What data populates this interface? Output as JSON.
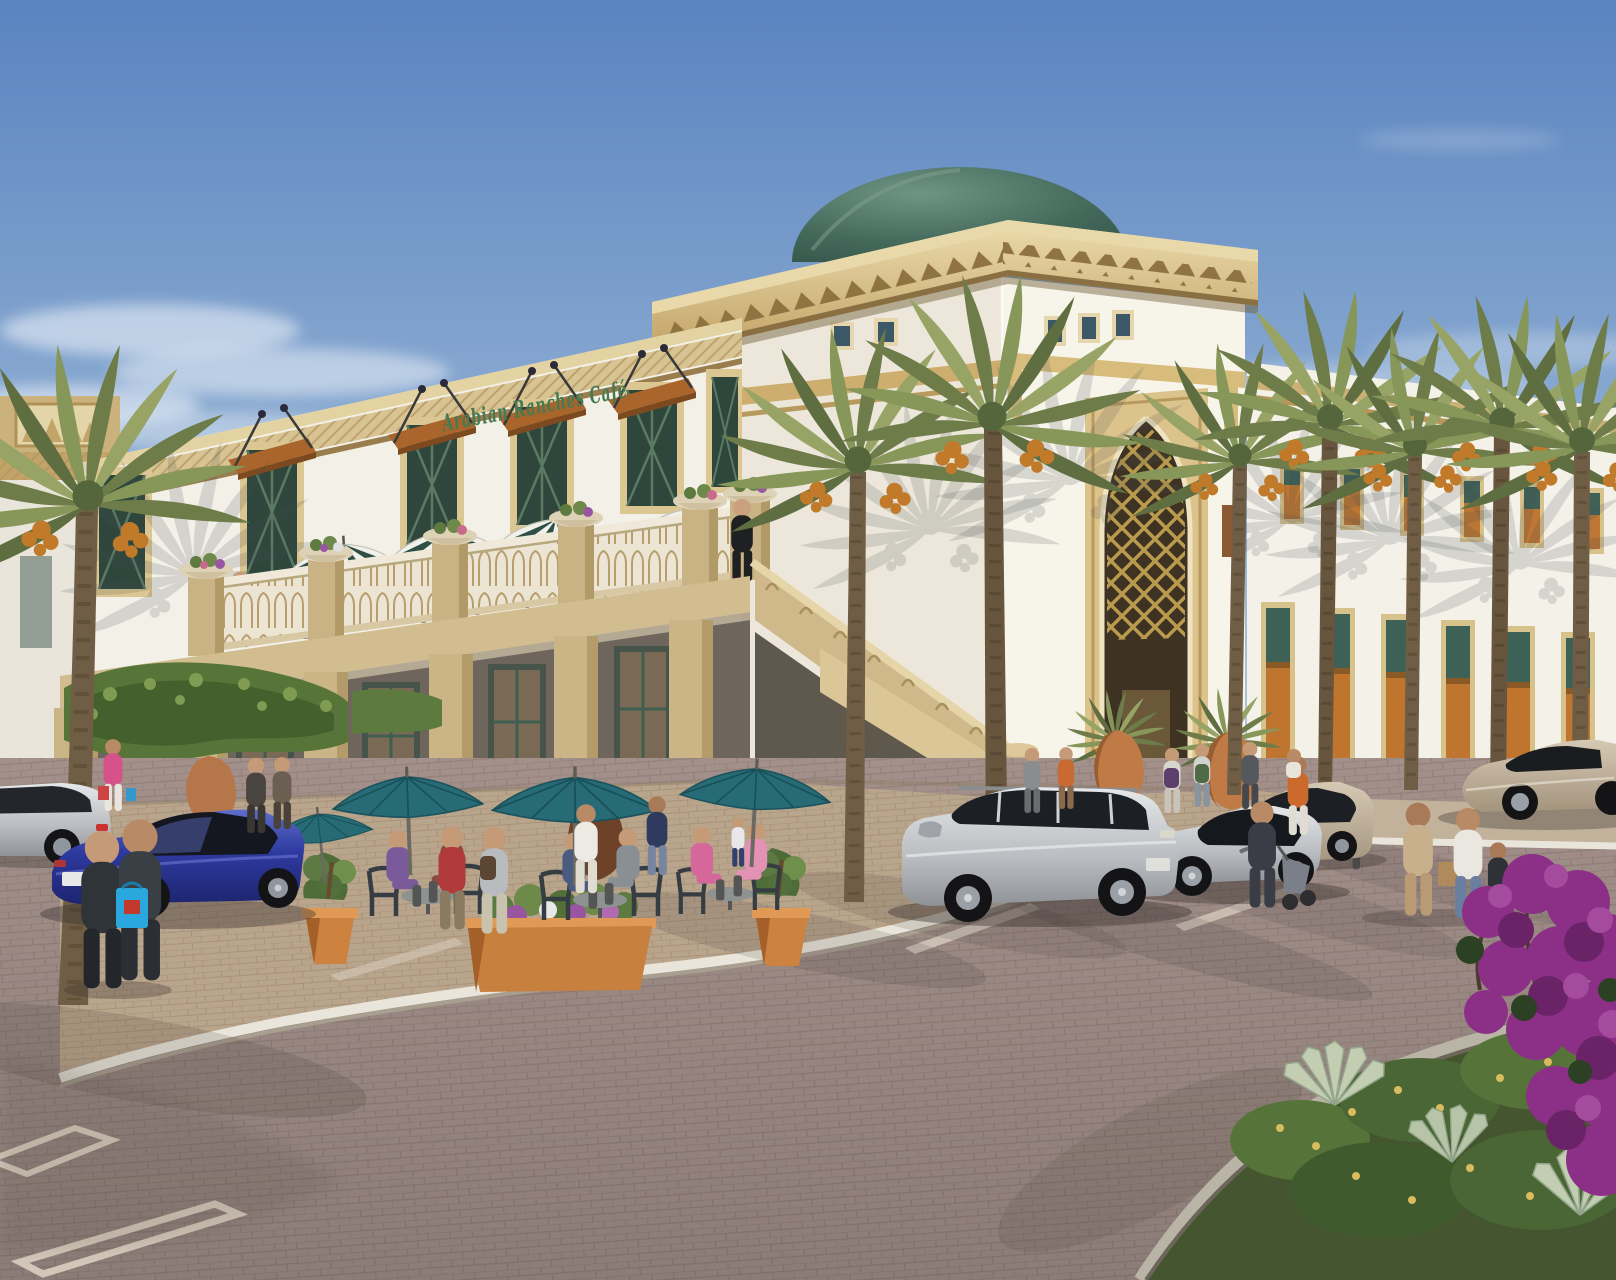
{
  "scene": {
    "type": "architectural-rendering",
    "subject": "Arabian Ranches Cafe retail building exterior with terrace, palms and parking",
    "signage": {
      "cafe_sign": "Arabian Ranches Café"
    },
    "colors": {
      "sky_top": "#5a84c0",
      "sky_mid": "#a9c3dc",
      "sky_horizon": "#e3ecf3",
      "wall_white": "#f3f0e8",
      "wall_shaded": "#ece7d9",
      "stone_gold": "#d7bd83",
      "stone_gold_light": "#e9d8aa",
      "stone_gold_dark": "#9c7c47",
      "sandstone": "#c9b384",
      "dome_green": "#477063",
      "window_green": "#2e463c",
      "awning_wood": "#a9652b",
      "umbrella_teal": "#266b75",
      "umbrella_stripe_green": "#2e4f45",
      "terracotta": "#c8803f",
      "paving_brick": "#a3908b",
      "paving_plaza": "#b9a48c",
      "curb_white": "#e9e5da",
      "palm_frond": "#6d7c49",
      "palm_trunk": "#6f5d46",
      "bougainvillea": "#8c3087",
      "car_blue": "#2e3aa0",
      "car_silver": "#c6c7ca",
      "car_beige": "#c1b19c"
    },
    "inventory": {
      "striped_terrace_umbrellas": 4,
      "teal_plaza_umbrellas": 4,
      "parked_cars": 7,
      "date_palms": 8,
      "entrance_urns": 2,
      "terracotta_planters": 3
    }
  }
}
